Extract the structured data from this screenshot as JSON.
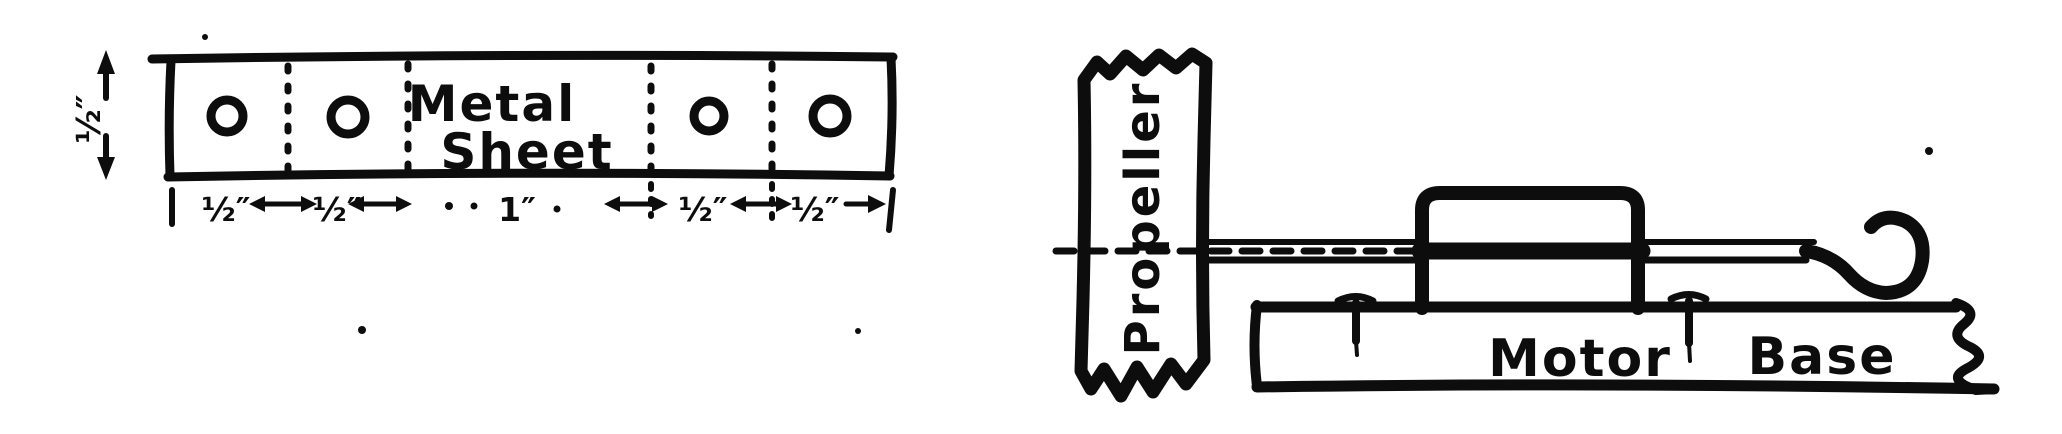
{
  "colors": {
    "ink": "#0d0d0d",
    "paper": "#ffffff"
  },
  "metal_sheet_figure": {
    "part_label_line1": "Metal",
    "part_label_line2": "Sheet",
    "height_dimension": "½″",
    "width_dimensions": [
      "½″",
      "½″",
      "1″",
      "½″",
      "½″"
    ]
  },
  "motor_assembly_figure": {
    "propeller_label": "Propeller",
    "motor_label": "Motor",
    "base_label": "Base"
  }
}
